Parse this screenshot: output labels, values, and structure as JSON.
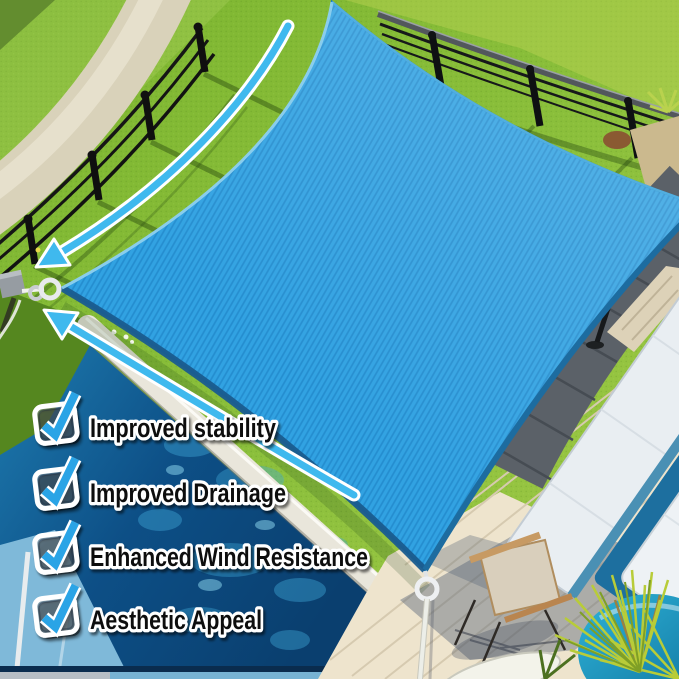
{
  "features": {
    "items": [
      {
        "label": "Improved stability",
        "icon": "checkbox-checked-icon"
      },
      {
        "label": "Improved Drainage",
        "icon": "checkbox-checked-icon"
      },
      {
        "label": "Enhanced Wind Resistance",
        "icon": "checkbox-checked-icon"
      },
      {
        "label": "Aesthetic Appeal",
        "icon": "checkbox-checked-icon"
      }
    ]
  },
  "colors": {
    "sail_blue": "#31a2e2",
    "sail_edge_navy": "#1a5c8e",
    "check_blue": "#29a4e6",
    "arrow_blue": "#3fb9ee",
    "outline_white": "#ffffff",
    "text_black": "#0e0e0e",
    "pool_blue": "#0d4f86",
    "lawn_green": "#82bb35",
    "deck_gray": "#5b6168",
    "deck_cream": "#eee4cd"
  },
  "scene": {
    "subject": "blue square shade sail suspended over a backyard pool area",
    "objects": [
      "shade-sail",
      "d-ring",
      "corner-rope",
      "curved-arrow",
      "lawn",
      "garden-path",
      "metal-fence",
      "hedge",
      "swimming-pool",
      "pool-coping",
      "dark-deck",
      "wood-deck",
      "sun-loungers",
      "pillows",
      "wooden-chair",
      "potted-palm",
      "planter",
      "surfboard"
    ]
  }
}
